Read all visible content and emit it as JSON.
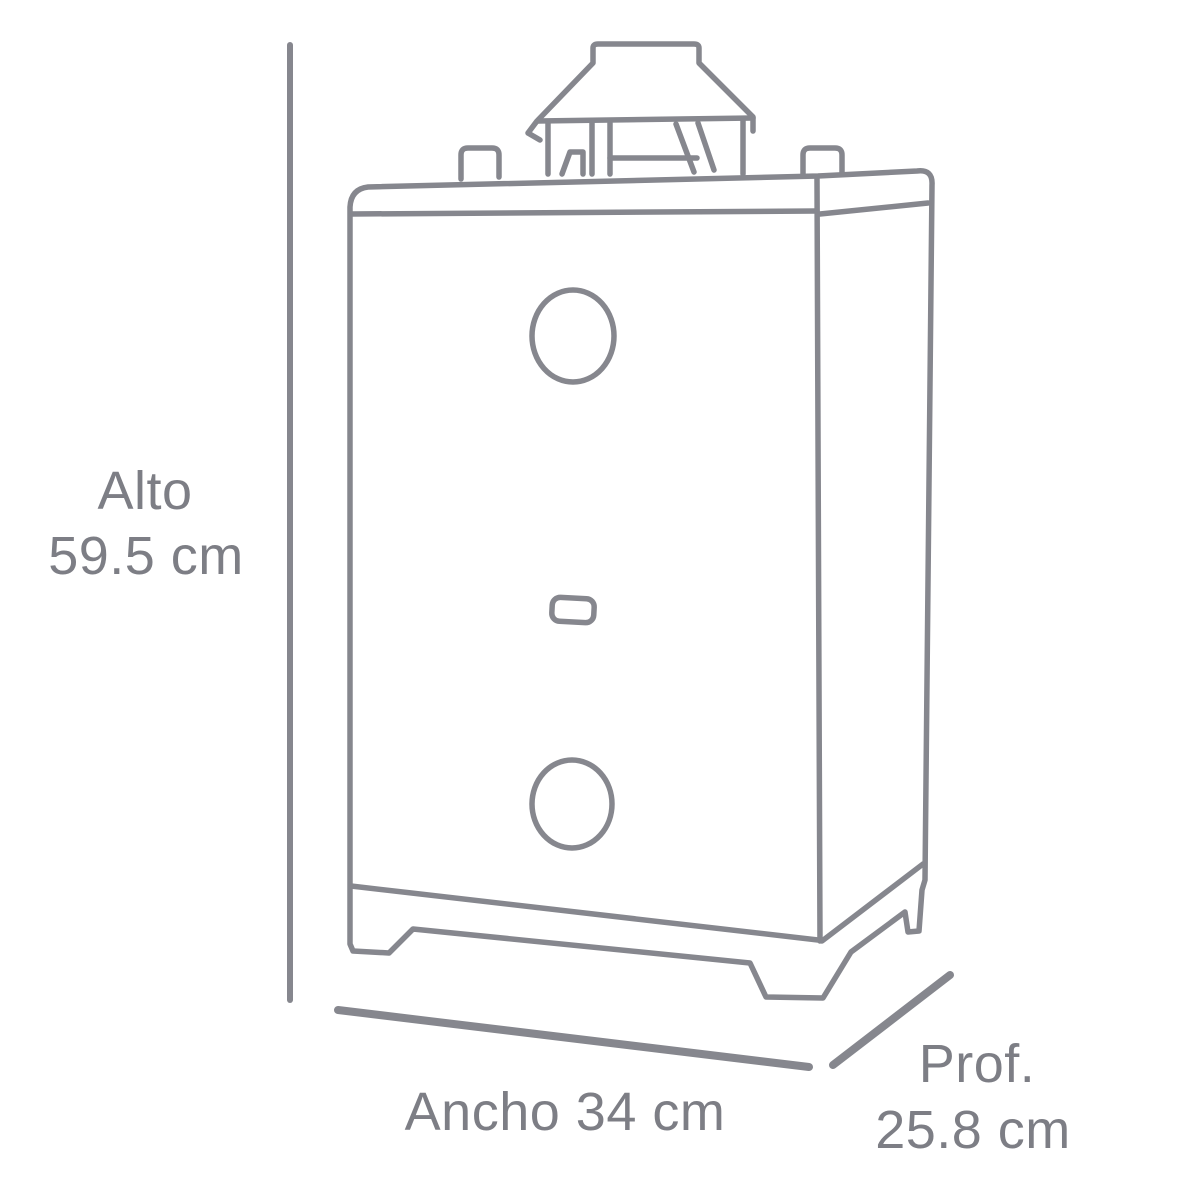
{
  "diagram": {
    "subject": "water-heater-outline-drawing",
    "dimensions": {
      "height": {
        "label": "Alto",
        "value": "59.5 cm"
      },
      "width": {
        "label": "Ancho",
        "value": "34 cm"
      },
      "depth": {
        "label": "Prof.",
        "value": "25.8 cm"
      }
    },
    "colors": {
      "line": "#86878e",
      "text": "#7d7e85",
      "background": "#ffffff"
    }
  }
}
